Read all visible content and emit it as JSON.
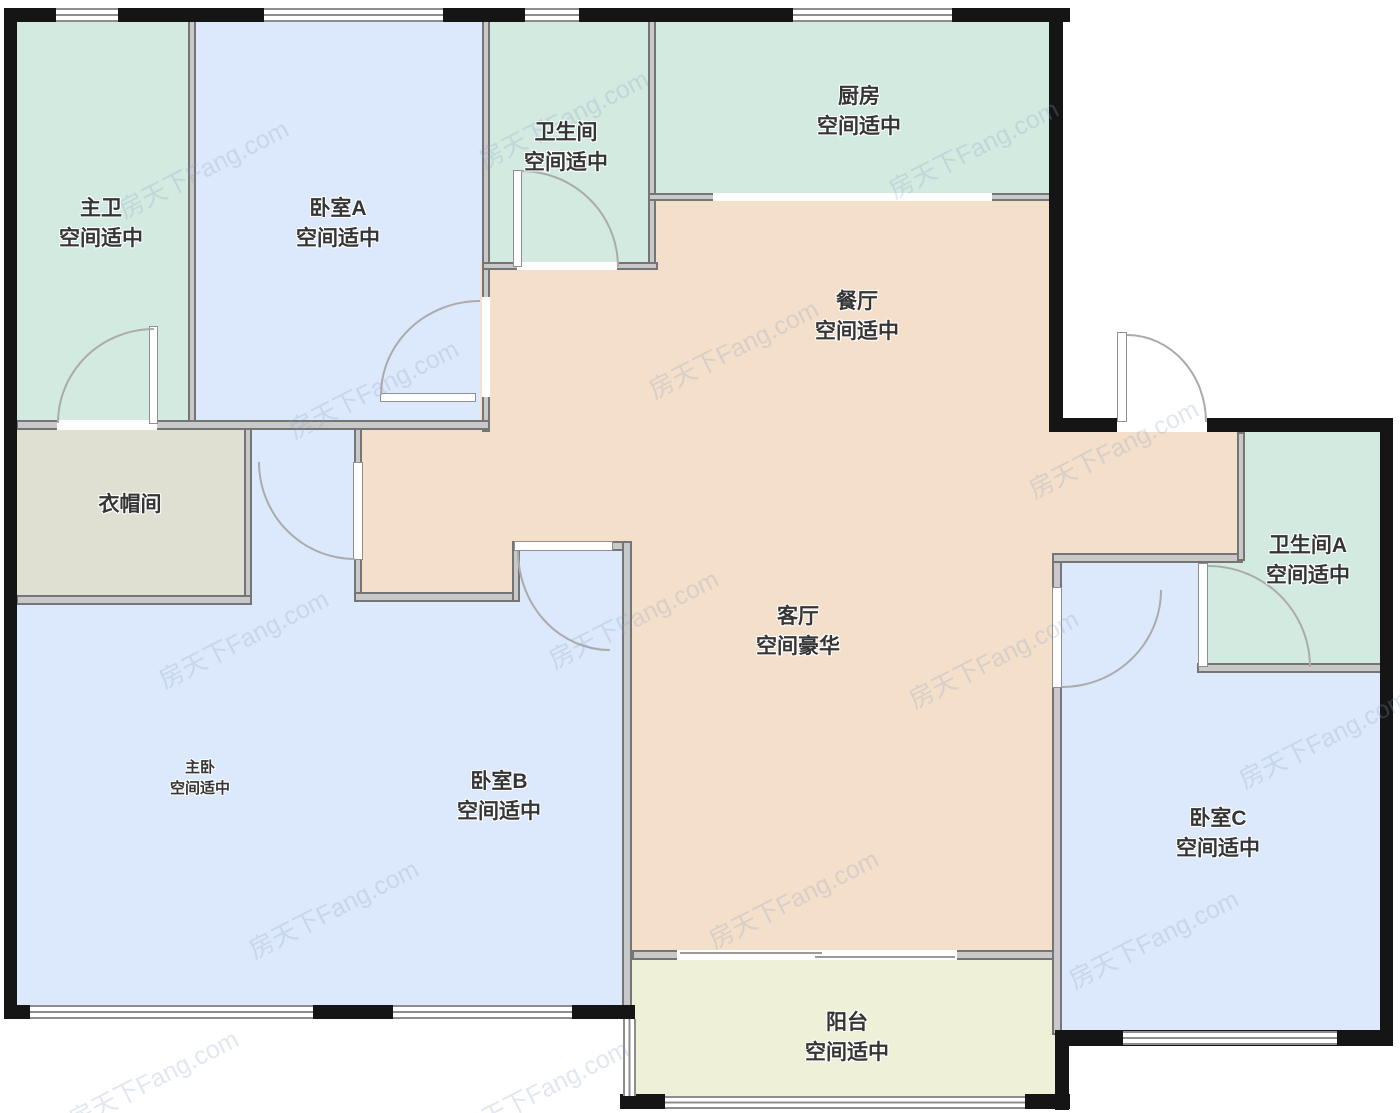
{
  "watermark": "房天下Fang.com",
  "rooms": {
    "zhuwei": {
      "name": "主卫",
      "grade": "空间适中"
    },
    "woshiA": {
      "name": "卧室A",
      "grade": "空间适中"
    },
    "weishengjian": {
      "name": "卫生间",
      "grade": "空间适中"
    },
    "chufang": {
      "name": "厨房",
      "grade": "空间适中"
    },
    "canting": {
      "name": "餐厅",
      "grade": "空间适中"
    },
    "yimaojian": {
      "name": "衣帽间",
      "grade": ""
    },
    "keting": {
      "name": "客厅",
      "grade": "空间豪华"
    },
    "weishengjianA": {
      "name": "卫生间A",
      "grade": "空间适中"
    },
    "zhuwo": {
      "name": "主卧",
      "grade": "空间适中"
    },
    "woshiB": {
      "name": "卧室B",
      "grade": "空间适中"
    },
    "woshiC": {
      "name": "卧室C",
      "grade": "空间适中"
    },
    "yangtai": {
      "name": "阳台",
      "grade": "空间适中"
    }
  },
  "colors": {
    "bathroom_green": "#d2eae0",
    "bedroom_blue": "#dce8fb",
    "living_tan": "#f3dfca",
    "cloakroom_gray": "#dfdfd2",
    "balcony_yellow": "#eef0d8",
    "exterior_wall": "#151515",
    "interior_wall": "#c9c9c9"
  }
}
